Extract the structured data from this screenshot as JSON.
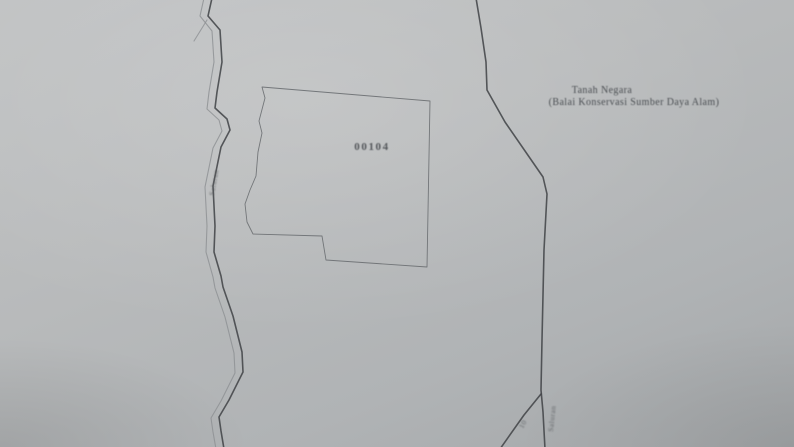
{
  "map": {
    "parcel": {
      "number": "00104"
    },
    "annotations": {
      "state_land_line1": "Tanah Negara",
      "state_land_line2": "(Balai Konservasi Sumber Daya Alam)",
      "left_boundary_label": "Saluran",
      "bottom_right_label": "Saluran",
      "bottom_right_number": "10"
    },
    "colors": {
      "paper": "#b9bbbc",
      "boundary_line_dark": "#3f4245",
      "boundary_line_light": "#8d9093",
      "parcel_outline": "#6a6e71",
      "text": "#4a4e52"
    }
  }
}
